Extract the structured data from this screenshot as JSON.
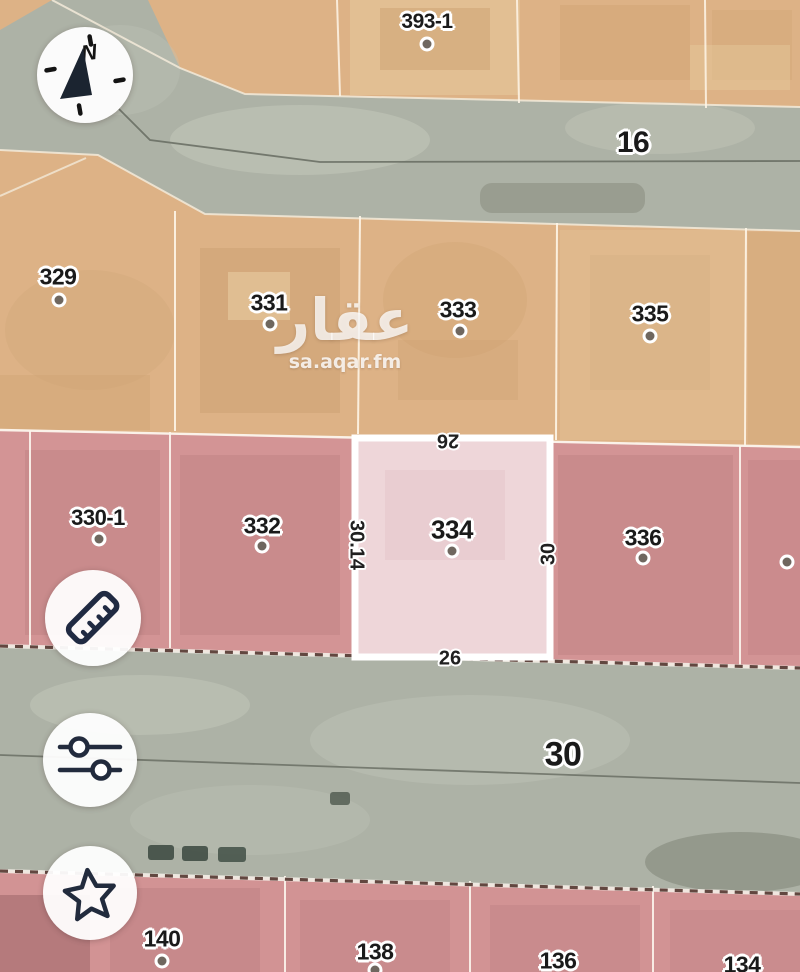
{
  "watermark": {
    "logo": "عقار",
    "domain": "sa.aqar.fm"
  },
  "compass": {
    "north_label": "N"
  },
  "streets": {
    "top": "16",
    "middle": "30"
  },
  "selected_parcel": {
    "number": "334",
    "dim_top": "26",
    "dim_bottom": "26",
    "dim_left": "30.14",
    "dim_right": "30"
  },
  "parcels": {
    "top_block": [
      {
        "number": "393-1"
      }
    ],
    "row_orange": [
      {
        "number": "329"
      },
      {
        "number": "331"
      },
      {
        "number": "333"
      },
      {
        "number": "335"
      }
    ],
    "row_pink": [
      {
        "number": "330-1"
      },
      {
        "number": "332"
      },
      {
        "number": "336"
      }
    ],
    "row_bottom": [
      {
        "number": "140"
      },
      {
        "number": "138"
      },
      {
        "number": "136"
      },
      {
        "number": "134"
      }
    ]
  },
  "colors": {
    "parcel_orange": "#ddb286",
    "parcel_pink": "#d39495",
    "selected_parcel_fill": "#eed6d9",
    "road": "#adb2a6",
    "icon_navy": "#222b3d",
    "label_outline": "#ffffff"
  }
}
